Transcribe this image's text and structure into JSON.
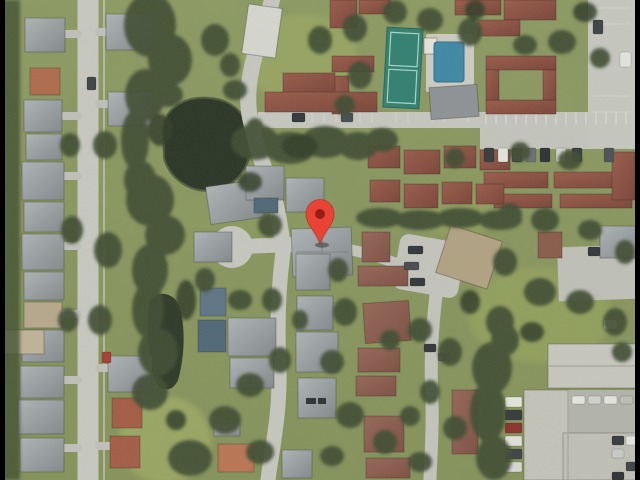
{
  "window": {
    "width": 640,
    "height": 480,
    "letterbox_color": "#000000"
  },
  "map": {
    "view_type": "satellite-aerial",
    "aria_label": "Satellite aerial map of a suburban residential neighborhood with a red location marker pin",
    "marker": {
      "shape": "map-pin",
      "color": "#EA4335",
      "inner_color": "#8E1B12"
    },
    "palette": {
      "grass": "#8C9A60",
      "grass_light": "#9AA763",
      "canopy": "#3C4B2F",
      "road": "#CBCBC5",
      "roof_gray": "#9AA0A5",
      "roof_red": "#8D5044",
      "roof_terracotta": "#B06A4B",
      "roof_tan": "#B5A384",
      "water": "#232E21",
      "pool": "#3C87A8",
      "tennis_court": "#2F7F70",
      "clubhouse": "#8E9297",
      "commercial_roof": "#CAC9C1"
    },
    "features": [
      "houses",
      "condominiums",
      "residential-streets",
      "cul-de-sac",
      "pond",
      "second-pond",
      "tennis-court",
      "swimming-pool",
      "clubhouse",
      "parking-lots",
      "parked-cars",
      "tree-canopy",
      "lawns",
      "commercial-buildings"
    ]
  }
}
